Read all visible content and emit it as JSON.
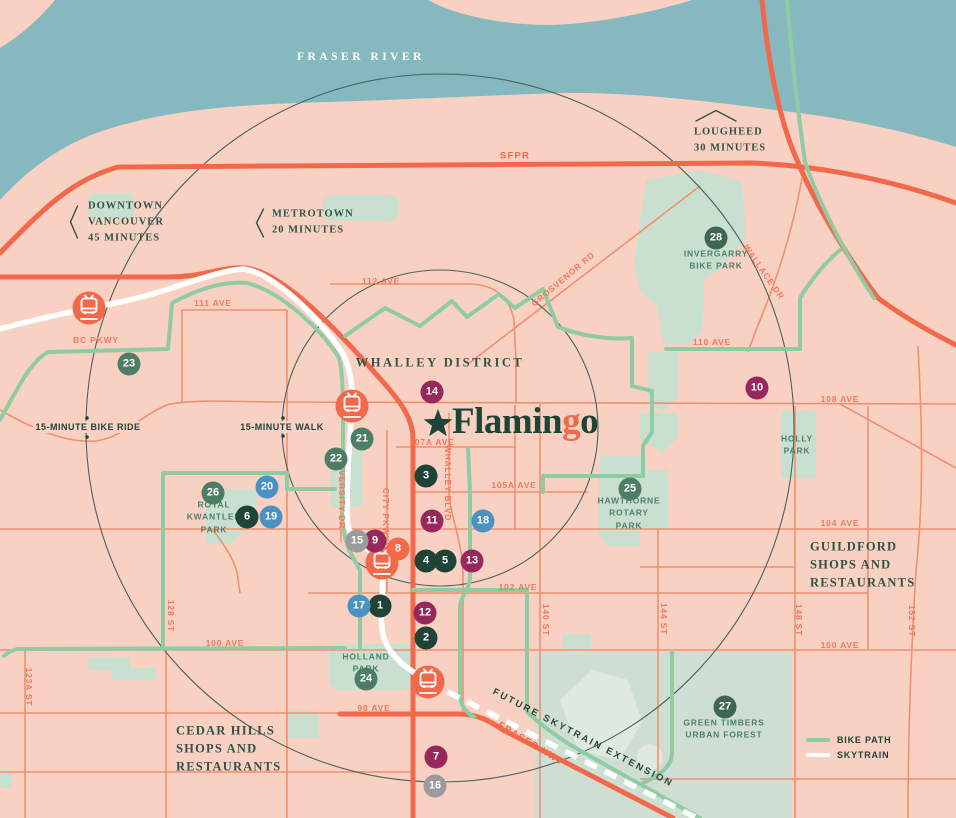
{
  "colors": {
    "water": "#86B9BF",
    "land": "#F9D1C3",
    "road_major": "#F2684B",
    "road_minor": "#F0906F",
    "bike_path": "#8FCBA3",
    "skytrain": "#FFFFFF",
    "park": "#C9E0D1",
    "forest": "#CFDED3",
    "forest_light": "#DEE9DF",
    "ring_line": "#4A625A",
    "label_orange": "#F1795C",
    "label_serif_green": "#2F5347",
    "label_park_green": "#4E8069",
    "label_dark": "#21403A",
    "logo_green": "#1E4337",
    "logo_accent": "#F2684B",
    "markers": {
      "green": "#4D7D65",
      "dark": "#1E4337",
      "mid": "#3C6852",
      "purple": "#97285C",
      "blue": "#4B92C3",
      "gray": "#9B9B9B",
      "orange": "#F26A4B"
    }
  },
  "logo": {
    "part1": "Flamin",
    "accent": "g",
    "part2": "o"
  },
  "legend": {
    "bike_path": "BIKE PATH",
    "skytrain": "SKYTRAIN"
  },
  "area_labels": [
    {
      "text": "FRASER RIVER",
      "x": 361,
      "y": 57,
      "cls": "river center"
    },
    {
      "text": "WHALLEY DISTRICT",
      "x": 440,
      "y": 363,
      "cls": "district center"
    },
    {
      "text": "GUILDFORD\nSHOPS AND\nRESTAURANTS",
      "x": 810,
      "y": 565,
      "cls": "big left"
    },
    {
      "text": "CEDAR HILLS\nSHOPS AND\nRESTAURANTS",
      "x": 176,
      "y": 749,
      "cls": "big left"
    }
  ],
  "destinations": [
    {
      "text": "DOWNTOWN\nVANCOUVER\n45 MINUTES",
      "x": 88,
      "y": 222,
      "cls": "dest left"
    },
    {
      "text": "METROTOWN\n20 MINUTES",
      "x": 272,
      "y": 222,
      "cls": "dest left"
    },
    {
      "text": "LOUGHEED\n30 MINUTES",
      "x": 694,
      "y": 140,
      "cls": "dest left"
    }
  ],
  "radius_labels": [
    {
      "text": "15-MINUTE BIKE RIDE",
      "x": 88,
      "y": 427
    },
    {
      "text": "15-MINUTE WALK",
      "x": 282,
      "y": 427
    }
  ],
  "street_labels": [
    {
      "text": "111 AVE",
      "x": 213,
      "y": 303
    },
    {
      "text": "112 AVE",
      "x": 381,
      "y": 281
    },
    {
      "text": "110 AVE",
      "x": 712,
      "y": 342
    },
    {
      "text": "108 AVE",
      "x": 840,
      "y": 399
    },
    {
      "text": "107A AVE",
      "x": 432,
      "y": 442
    },
    {
      "text": "105A AVE",
      "x": 514,
      "y": 485
    },
    {
      "text": "104 AVE",
      "x": 840,
      "y": 523
    },
    {
      "text": "102 AVE",
      "x": 518,
      "y": 587
    },
    {
      "text": "100 AVE",
      "x": 225,
      "y": 643
    },
    {
      "text": "100 AVE",
      "x": 840,
      "y": 645
    },
    {
      "text": "98 AVE",
      "x": 374,
      "y": 708
    },
    {
      "text": "123A ST",
      "x": 29,
      "y": 687,
      "rot": 90
    },
    {
      "text": "128 ST",
      "x": 171,
      "y": 616,
      "rot": 90
    },
    {
      "text": "140 ST",
      "x": 546,
      "y": 620,
      "rot": 90
    },
    {
      "text": "144 ST",
      "x": 664,
      "y": 619,
      "rot": 90
    },
    {
      "text": "148 ST",
      "x": 799,
      "y": 620,
      "rot": 90
    },
    {
      "text": "152 ST",
      "x": 912,
      "y": 621,
      "rot": 90
    },
    {
      "text": "UNIVERSITY DR",
      "x": 342,
      "y": 491,
      "rot": 90
    },
    {
      "text": "CITY PKWY",
      "x": 386,
      "y": 515,
      "rot": 90
    },
    {
      "text": "WHALLEY BLVD",
      "x": 448,
      "y": 483,
      "rot": 90
    },
    {
      "text": "BC PKWY",
      "x": 96,
      "y": 340
    },
    {
      "text": "SFPR",
      "x": 515,
      "y": 156,
      "cls": "hwy"
    },
    {
      "text": "GROSVENOR RD",
      "x": 563,
      "y": 279,
      "rot": -40
    },
    {
      "text": "WALLACE DR",
      "x": 764,
      "y": 272,
      "rot": 55
    },
    {
      "text": "FRASER HWY",
      "x": 531,
      "y": 744,
      "rot": 31,
      "cls": "hwy"
    }
  ],
  "rail_labels": [
    {
      "text": "FUTURE SKYTRAIN EXTENSION",
      "x": 583,
      "y": 738,
      "rot": 27.5
    }
  ],
  "park_labels": [
    {
      "text": "INVERGARRY\nBIKE PARK",
      "x": 716,
      "y": 260
    },
    {
      "text": "ROYAL\nKWANTLEN\nPARK",
      "x": 214,
      "y": 517
    },
    {
      "text": "HAWTHORNE\nROTARY\nPARK",
      "x": 629,
      "y": 513
    },
    {
      "text": "HOLLY\nPARK",
      "x": 797,
      "y": 445
    },
    {
      "text": "HOLLAND\nPARK",
      "x": 366,
      "y": 663
    },
    {
      "text": "GREEN TIMBERS\nURBAN FOREST",
      "x": 724,
      "y": 729
    }
  ],
  "markers": [
    {
      "n": "1",
      "color": "dark",
      "x": 380,
      "y": 606
    },
    {
      "n": "2",
      "color": "dark",
      "x": 426,
      "y": 638
    },
    {
      "n": "3",
      "color": "dark",
      "x": 426,
      "y": 476
    },
    {
      "n": "4",
      "color": "dark",
      "x": 426,
      "y": 561
    },
    {
      "n": "5",
      "color": "dark",
      "x": 445,
      "y": 561
    },
    {
      "n": "6",
      "color": "dark",
      "x": 247,
      "y": 517
    },
    {
      "n": "7",
      "color": "purple",
      "x": 436,
      "y": 757
    },
    {
      "n": "8",
      "color": "orange",
      "x": 398,
      "y": 549
    },
    {
      "n": "9",
      "color": "purple",
      "x": 375,
      "y": 541
    },
    {
      "n": "10",
      "color": "purple",
      "x": 757,
      "y": 388
    },
    {
      "n": "11",
      "color": "purple",
      "x": 432,
      "y": 521
    },
    {
      "n": "12",
      "color": "purple",
      "x": 425,
      "y": 613
    },
    {
      "n": "13",
      "color": "purple",
      "x": 472,
      "y": 561
    },
    {
      "n": "14",
      "color": "purple",
      "x": 432,
      "y": 392
    },
    {
      "n": "15",
      "color": "gray",
      "x": 357,
      "y": 541
    },
    {
      "n": "16",
      "color": "gray",
      "x": 435,
      "y": 786
    },
    {
      "n": "17",
      "color": "blue",
      "x": 359,
      "y": 606
    },
    {
      "n": "18",
      "color": "blue",
      "x": 483,
      "y": 521
    },
    {
      "n": "19",
      "color": "blue",
      "x": 271,
      "y": 517
    },
    {
      "n": "20",
      "color": "blue",
      "x": 267,
      "y": 487
    },
    {
      "n": "21",
      "color": "green",
      "x": 362,
      "y": 439
    },
    {
      "n": "22",
      "color": "green",
      "x": 336,
      "y": 459
    },
    {
      "n": "23",
      "color": "green",
      "x": 129,
      "y": 364
    },
    {
      "n": "24",
      "color": "green",
      "x": 366,
      "y": 679
    },
    {
      "n": "25",
      "color": "green",
      "x": 630,
      "y": 489
    },
    {
      "n": "26",
      "color": "green",
      "x": 213,
      "y": 493
    },
    {
      "n": "27",
      "color": "mid",
      "x": 725,
      "y": 707
    },
    {
      "n": "28",
      "color": "mid",
      "x": 716,
      "y": 238
    }
  ],
  "stations": [
    {
      "x": 89,
      "y": 308
    },
    {
      "x": 352,
      "y": 406
    },
    {
      "x": 382,
      "y": 563
    },
    {
      "x": 428,
      "y": 682
    }
  ]
}
